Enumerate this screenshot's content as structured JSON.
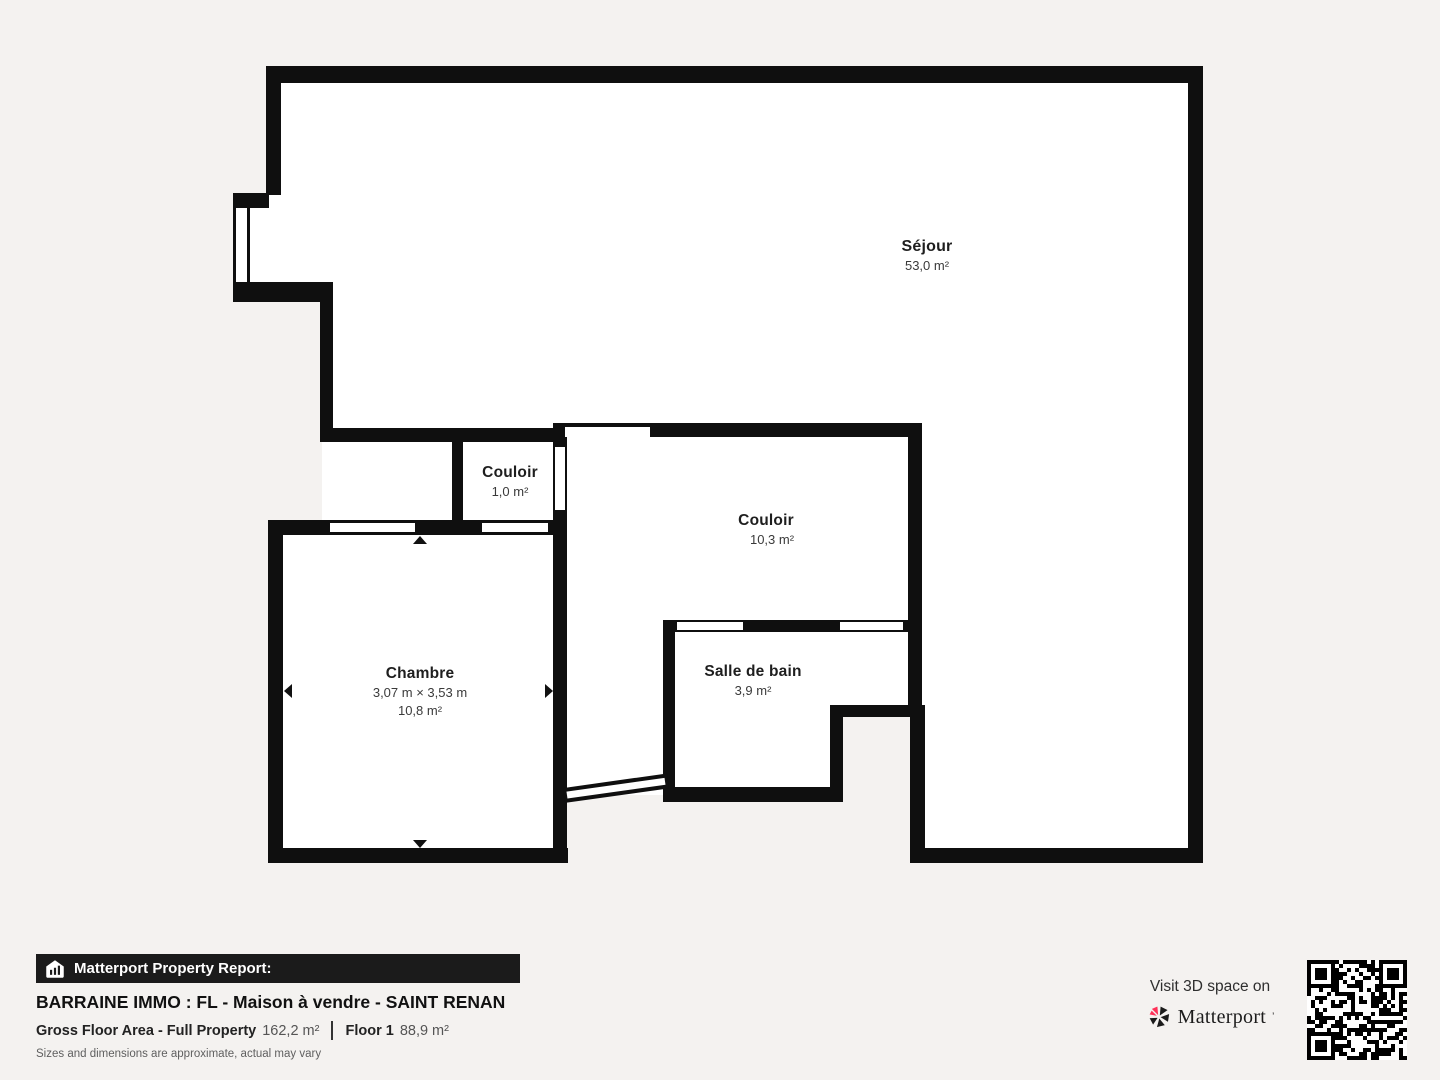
{
  "plan": {
    "rooms": [
      {
        "id": "sejour",
        "name": "Séjour",
        "area": "53,0 m²"
      },
      {
        "id": "couloir-small",
        "name": "Couloir",
        "area": "1,0 m²"
      },
      {
        "id": "couloir",
        "name": "Couloir",
        "area": "10,3 m²"
      },
      {
        "id": "chambre",
        "name": "Chambre",
        "dimensions": "3,07 m × 3,53 m",
        "area": "10,8 m²"
      },
      {
        "id": "salle-de-bain",
        "name": "Salle de bain",
        "area": "3,9 m²"
      }
    ],
    "wall_color": "#0f0f0f",
    "interior_color": "#ffffff",
    "background_color": "#f4f2f0"
  },
  "footer": {
    "icon": "matterport-house-icon",
    "report_label": "Matterport Property Report:",
    "title": "BARRAINE IMMO : FL - Maison à vendre - SAINT RENAN",
    "gross_floor_label": "Gross Floor Area - Full Property",
    "gross_floor_value": "162,2 m²",
    "floor_label": "Floor 1",
    "floor_value": "88,9 m²",
    "disclaimer": "Sizes and dimensions are approximate, actual may vary"
  },
  "cta": {
    "visit_text": "Visit 3D space on",
    "brand": "Matterport",
    "logo_icon": "matterport-pinwheel-icon",
    "brand_accent_color": "#ff3158",
    "qr": "qr-code"
  }
}
